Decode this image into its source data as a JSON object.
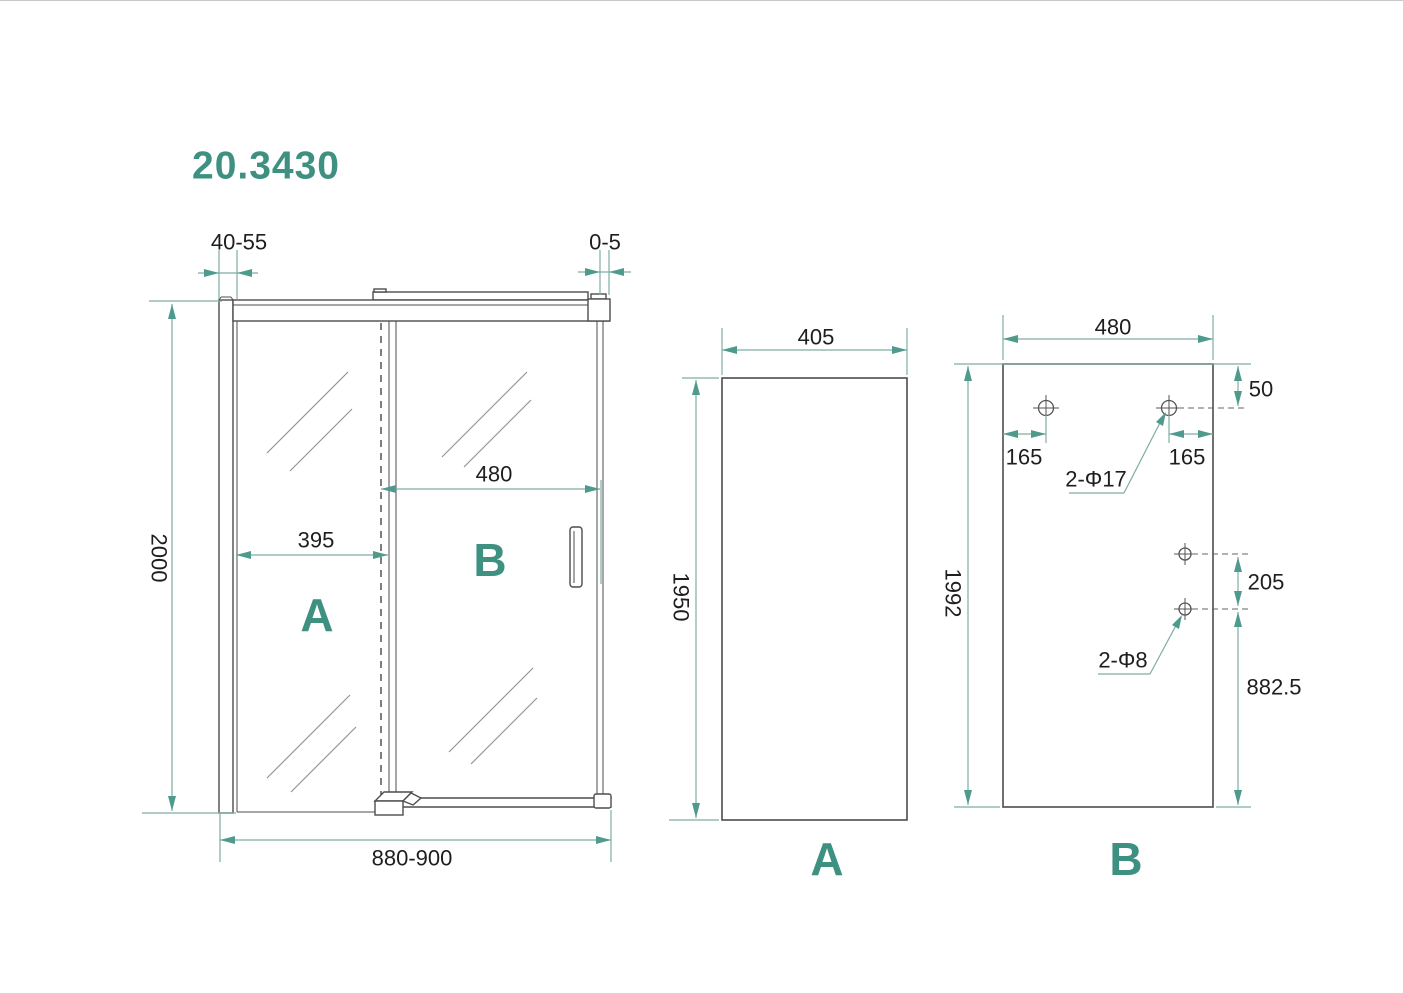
{
  "title": "20.3430",
  "colors": {
    "accent": "#3E9181",
    "dimension_line": "#7FACA2",
    "drawing_line": "#4D4D4D",
    "dimension_text": "#1E1E1E",
    "background": "#FFFFFF"
  },
  "front_view": {
    "panel_a_label": "A",
    "panel_b_label": "B",
    "dim_wall_profile_adjust": "40-55",
    "dim_door_gap": "0-5",
    "dim_total_height": "2000",
    "dim_fixed_panel_width": "395",
    "dim_door_width": "480",
    "dim_total_width": "880-900"
  },
  "panel_a_view": {
    "view_label": "A",
    "dim_glass_width": "405",
    "dim_glass_height": "1950"
  },
  "panel_b_view": {
    "view_label": "B",
    "dim_glass_width": "480",
    "dim_glass_height": "1992",
    "dim_top_hole_offset": "50",
    "dim_left_hole_inset": "165",
    "dim_right_hole_inset": "165",
    "top_holes_label": "2-Φ17",
    "dim_side_hole_spacing": "205",
    "dim_side_hole_bottom": "882.5",
    "side_holes_label": "2-Φ8"
  }
}
